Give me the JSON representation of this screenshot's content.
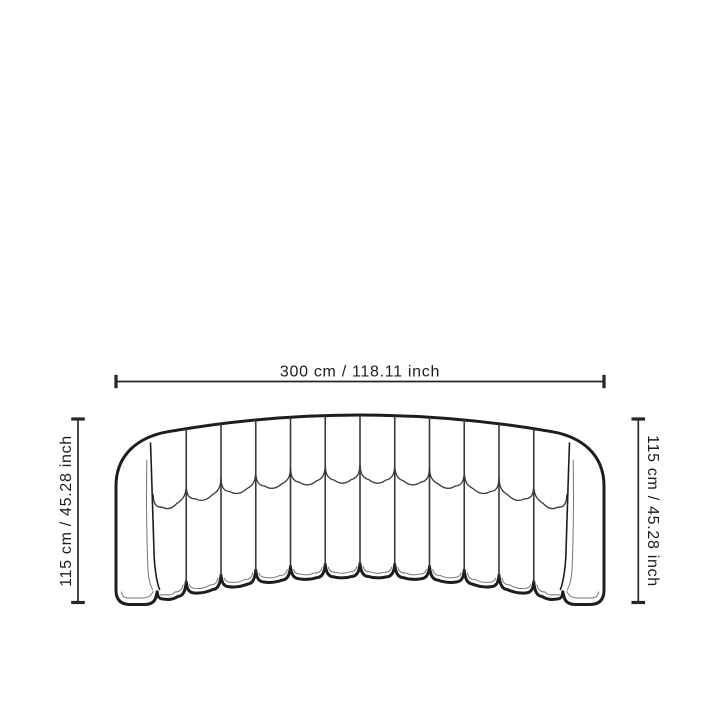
{
  "page": {
    "background_color": "#ffffff"
  },
  "diagram": {
    "subject": "Curved channel-tufted sofa, front elevation drawing",
    "drawing": {
      "name": "sofa-front-view",
      "channel_count": 12,
      "line_color": "#1d1d1d",
      "mid_line_color": "#383838",
      "detail_line_color": "#767676",
      "fill_color": "#ffffff"
    },
    "dimensions": {
      "width_label": "300 cm / 118.11 inch",
      "height_left_label": "115 cm / 45.28 inch",
      "height_right_label": "115 cm / 45.28 inch"
    }
  }
}
